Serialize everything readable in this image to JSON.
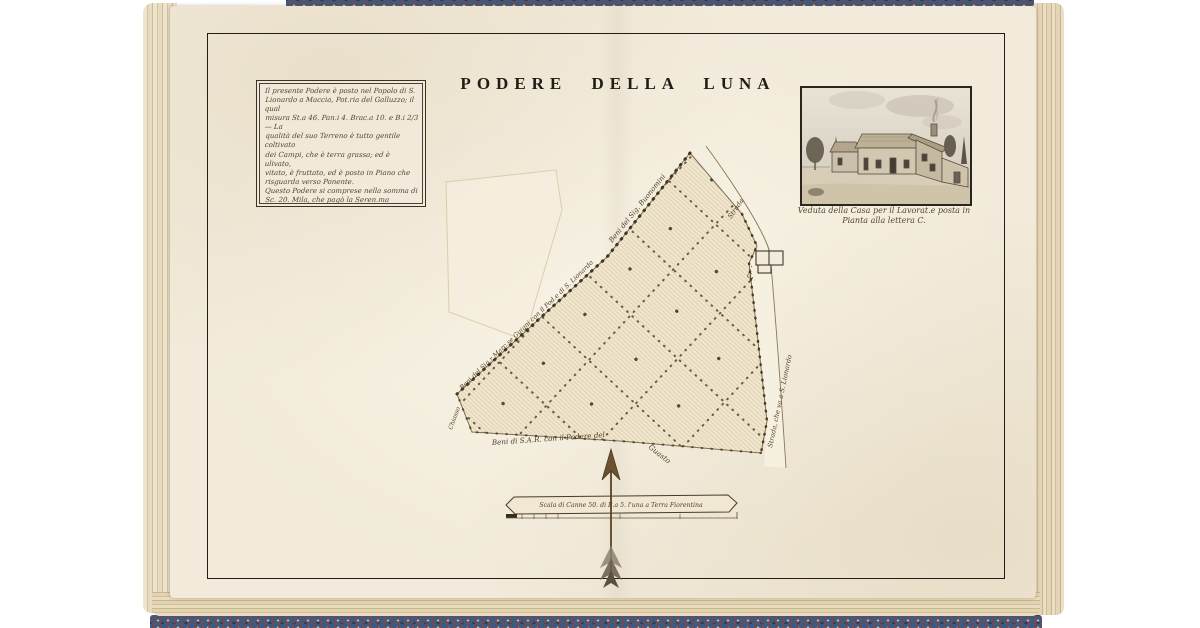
{
  "page": {
    "title": "PODERE DELLA LUNA",
    "description_box": {
      "lines": [
        "Il presente Podere è posto nel Popolo di S.",
        "Lionardo a Maccia, Pot.ria del Galluzzo; il qual",
        "misura St.a 46. Pan.i 4. Brac.a 10. e B.i 2/3 — La",
        "qualità del suo Terreno è tutto gentile coltivato",
        "dei Campi, che è terra grassa; ed è ulivato,",
        "vitato, è fruttato, ed è posto in Piano che",
        "risguarda verso Ponente.",
        "Questo Podere si comprese nella somma di",
        "Sc. 20. Mila, che pagò la Seren.ma Granduch.a",
        "Maria Maddalena d'Austria sotto dì",
        "7. Dicembre al Sig.re Carlo Magalotti,",
        "per la compra, da lui fatta, come",
        "meglio in filza a ________"
      ]
    },
    "vignette": {
      "caption_line1": "Veduta della Casa per il Lavorat.e posta in",
      "caption_line2": "Pianta alla lettera C."
    },
    "map": {
      "label_top_edge": "Beni del Sig. Buonomini",
      "label_left_edge": "Beni del Sig.r Marc.se Guigni con il Pod.e di S. Lionardo",
      "label_bottom_edge": "Beni di S.A.R. con il Podere del",
      "label_bottom_edge_2": "Guasto",
      "label_road_top": "Strada",
      "label_road_right": "Strada, che va a S. Lionardo",
      "label_chiasso": "Chiasso",
      "house_letter": "C."
    },
    "scale_bar_label": "Scala di Canne 50. di B.a 5. l'una a Terra Fiorentina",
    "colors": {
      "paper": "#f2ebdb",
      "ink": "#241d13",
      "hand_ink": "#54452e",
      "marble_blue": "#41597c",
      "frame": "#221c14"
    }
  }
}
